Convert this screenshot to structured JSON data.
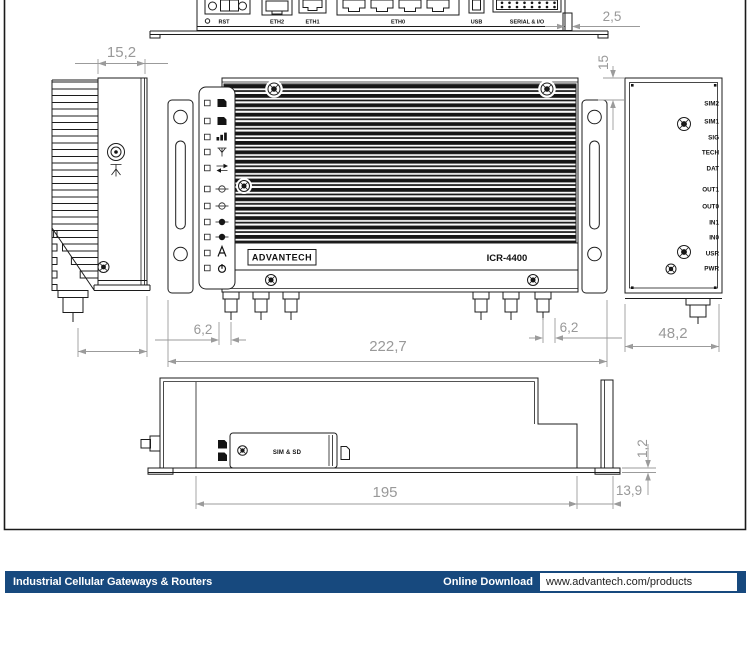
{
  "footer": {
    "category_label": "Industrial Cellular Gateways & Routers",
    "download_label": "Online Download",
    "download_url": "www.advantech.com/products",
    "bar_color": "#17497E"
  },
  "drawing": {
    "brand_logo": "ADVANTECH",
    "model": "ICR-4400",
    "sim_sd_label": "SIM & SD",
    "port_labels": {
      "rst": "RST",
      "eth2": "ETH2",
      "eth1": "ETH1",
      "eth0": "ETH0",
      "usb": "USB",
      "serial": "SERIAL & I/O"
    },
    "led_labels": [
      "SIM2",
      "SIM1",
      "SIG",
      "TECH",
      "DAT",
      "OUT1",
      "OUT0",
      "IN1",
      "IN0",
      "USR",
      "PWR"
    ],
    "led_icon_names": [
      "sim2-card-icon",
      "sim1-card-icon",
      "signal-strength-icon",
      "antenna-icon",
      "data-flow-icon",
      "output1-icon",
      "output0-icon",
      "input1-icon",
      "input0-icon",
      "user-led-icon",
      "power-icon"
    ],
    "dimensions_mm": {
      "connector_offset": "2,5",
      "antenna_top_offset": "15,2",
      "lid_step_height": "15",
      "left_view_depth": "34,4",
      "antenna_left_offset": "6,2",
      "overall_width": "222,7",
      "antenna_right_offset": "6,2",
      "right_view_depth": "48,2",
      "base_length": "195",
      "bracket_offset": "13,9",
      "flange_thickness": "1,2"
    },
    "colors": {
      "line": "#1C1C1C",
      "dimension": "#9B9B9B"
    }
  }
}
